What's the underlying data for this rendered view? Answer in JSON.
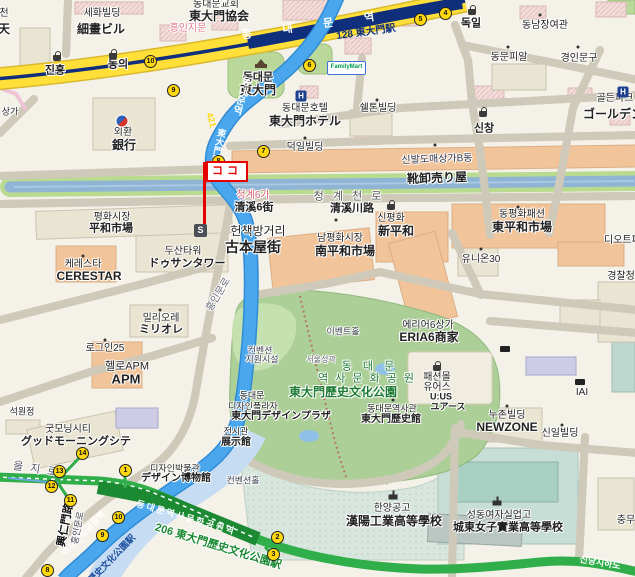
{
  "map": {
    "markers": {
      "koko": "ココ",
      "s": "S",
      "familymart": "FamilyMart"
    },
    "palette": {
      "bg": "#f4f1e8",
      "road_yellow": "#ffdf38",
      "line1_navy": "#0f2f7d",
      "line4_blue": "#4aa7ee",
      "line4_casing": "#2f8cd4",
      "line4_band": "#c6dcf2",
      "line2_green": "#2fae4a",
      "line2_dark": "#1c8a33",
      "stream_water": "#8fb4d4",
      "stream_bank": "#b9db90",
      "park_green": "#accf97",
      "park_light": "#c8e2b2",
      "bldg_salmon": "#f2c49a",
      "bldg_tan": "#eae4d2",
      "bldg_pink": "#f3dbd9",
      "bldg_lavender": "#cdcbe6",
      "school_teal": "#c7ded6",
      "exit_yellow": "#ffd80e",
      "flag_red": "#e60000",
      "park_label_green": "#1c7a33"
    },
    "labels": [
      {
        "i": "chun-ko",
        "t": "천",
        "x": 4,
        "y": 14,
        "s": 10
      },
      {
        "i": "chun-ja",
        "t": "天",
        "x": 4,
        "y": 29,
        "s": 12,
        "b": 1
      },
      {
        "i": "sehwa-ko",
        "t": "세화빌딩",
        "x": 102,
        "y": 14,
        "s": 10
      },
      {
        "i": "sehwa-ja",
        "t": "細畫ビル",
        "x": 101,
        "y": 29,
        "s": 12,
        "b": 1
      },
      {
        "i": "church-ko",
        "t": "동대문교회",
        "x": 216,
        "y": 5,
        "s": 10
      },
      {
        "i": "church-ja",
        "t": "東大門協会",
        "x": 219,
        "y": 16,
        "s": 12,
        "b": 1
      },
      {
        "i": "heunginjimun",
        "t": "흥인지문",
        "x": 188,
        "y": 29,
        "s": 10,
        "c": "#e2798f"
      },
      {
        "i": "jinheung",
        "t": "진흥",
        "x": 55,
        "y": 71,
        "s": 11,
        "b": 1
      },
      {
        "i": "dongui",
        "t": "동의",
        "x": 118,
        "y": 65,
        "s": 11,
        "b": 1
      },
      {
        "i": "line1-name",
        "t": "동 대 문 역",
        "x": 315,
        "y": 26,
        "s": 11,
        "b": 1,
        "c": "#fff",
        "r": -8,
        "ls": 14,
        "h": 0
      },
      {
        "i": "line1-code",
        "t": "128  東大門駅",
        "x": 366,
        "y": 33,
        "s": 10,
        "b": 1,
        "c": "#10307e",
        "r": -8,
        "h": 0
      },
      {
        "i": "dokil",
        "t": "독일",
        "x": 471,
        "y": 24,
        "s": 11,
        "b": 1
      },
      {
        "i": "dongnam",
        "t": "동남장여관",
        "x": 545,
        "y": 26,
        "s": 10
      },
      {
        "i": "dongmun",
        "t": "동문피알",
        "x": 509,
        "y": 58,
        "s": 10
      },
      {
        "i": "gyeongin",
        "t": "경인문구",
        "x": 579,
        "y": 59,
        "s": 10
      },
      {
        "i": "golden-ko",
        "t": "골든파크",
        "x": 615,
        "y": 99,
        "s": 10
      },
      {
        "i": "golden-ja",
        "t": "ゴールデン",
        "x": 613,
        "y": 114,
        "s": 12,
        "b": 1
      },
      {
        "i": "ddm-ko",
        "t": "동대문",
        "x": 258,
        "y": 78,
        "s": 11,
        "b": 1
      },
      {
        "i": "ddm-ja",
        "t": "東大門",
        "x": 258,
        "y": 90,
        "s": 12,
        "b": 1
      },
      {
        "i": "hotel-ko",
        "t": "동대문호텔",
        "x": 305,
        "y": 109,
        "s": 10
      },
      {
        "i": "hotel-ja",
        "t": "東大門ホテル",
        "x": 305,
        "y": 121,
        "s": 12,
        "b": 1
      },
      {
        "i": "sheldon",
        "t": "쉘톤빌딩",
        "x": 378,
        "y": 109,
        "s": 10
      },
      {
        "i": "sinchang",
        "t": "신창",
        "x": 484,
        "y": 129,
        "s": 11,
        "b": 1
      },
      {
        "i": "keb-ko",
        "t": "외환",
        "x": 123,
        "y": 133,
        "s": 10
      },
      {
        "i": "keb-ja",
        "t": "銀行",
        "x": 124,
        "y": 145,
        "s": 12,
        "b": 1
      },
      {
        "i": "deokil",
        "t": "덕일빌딩",
        "x": 305,
        "y": 148,
        "s": 10
      },
      {
        "i": "l4-name",
        "t": "동대문역",
        "x": 240,
        "y": 95,
        "s": 10,
        "b": 1,
        "c": "#fff",
        "v": 1,
        "r": 16,
        "h": 0
      },
      {
        "i": "l4-code",
        "t": "421",
        "x": 211,
        "y": 120,
        "s": 9,
        "b": 1,
        "c": "#ffd80e",
        "r": 74,
        "h": 0
      },
      {
        "i": "l4-ja",
        "t": "東大門駅",
        "x": 218,
        "y": 146,
        "s": 9,
        "b": 1,
        "c": "#fff",
        "v": 1,
        "r": 12,
        "h": 0
      },
      {
        "i": "shoe-ko",
        "t": "신발도매상가B동",
        "x": 437,
        "y": 160,
        "s": 10,
        "c": "#334",
        "r": -2
      },
      {
        "i": "shoe-ja",
        "t": "靴卸売り屋",
        "x": 437,
        "y": 178,
        "s": 12,
        "b": 1,
        "r": -2
      },
      {
        "i": "cg6-ko",
        "t": "청계6가",
        "x": 253,
        "y": 196,
        "s": 10,
        "c": "#d8607a"
      },
      {
        "i": "cg6-ja",
        "t": "清溪6街",
        "x": 254,
        "y": 208,
        "s": 11,
        "b": 1
      },
      {
        "i": "cgro-ko",
        "t": "청 계 천 로",
        "x": 349,
        "y": 197,
        "s": 11,
        "c": "#555",
        "ls": 3
      },
      {
        "i": "cgro-ja",
        "t": "清溪川路",
        "x": 352,
        "y": 209,
        "s": 11,
        "b": 1
      },
      {
        "i": "sp-ko",
        "t": "신평화",
        "x": 391,
        "y": 219,
        "s": 10
      },
      {
        "i": "sp-ja",
        "t": "新平和",
        "x": 396,
        "y": 231,
        "s": 12,
        "b": 1
      },
      {
        "i": "np-ko",
        "t": "남평화시장",
        "x": 340,
        "y": 239,
        "s": 10
      },
      {
        "i": "np-ja",
        "t": "南平和市場",
        "x": 345,
        "y": 251,
        "s": 12,
        "b": 1
      },
      {
        "i": "dp-ko",
        "t": "동평화패션",
        "x": 522,
        "y": 215,
        "s": 10
      },
      {
        "i": "dp-ja",
        "t": "東平和市場",
        "x": 522,
        "y": 227,
        "s": 12,
        "b": 1
      },
      {
        "i": "diot",
        "t": "디오트패션",
        "x": 627,
        "y": 241,
        "s": 10
      },
      {
        "i": "ph-ko",
        "t": "평화시장",
        "x": 112,
        "y": 218,
        "s": 10
      },
      {
        "i": "ph-ja",
        "t": "平和市場",
        "x": 111,
        "y": 229,
        "s": 11,
        "b": 1
      },
      {
        "i": "book-ko",
        "t": "헌책방거리",
        "x": 258,
        "y": 231,
        "s": 12
      },
      {
        "i": "book-ja",
        "t": "古本屋街",
        "x": 253,
        "y": 247,
        "s": 14,
        "b": 1
      },
      {
        "i": "ceres-ko",
        "t": "케레스타",
        "x": 83,
        "y": 265,
        "s": 10
      },
      {
        "i": "ceres-en",
        "t": "CERESTAR",
        "x": 89,
        "y": 276,
        "s": 12,
        "b": 1
      },
      {
        "i": "doosan-ko",
        "t": "두산타워",
        "x": 183,
        "y": 252,
        "s": 10
      },
      {
        "i": "doosan-ja",
        "t": "ドゥサンタワー",
        "x": 187,
        "y": 264,
        "s": 11,
        "b": 1
      },
      {
        "i": "union30",
        "t": "유니온30",
        "x": 481,
        "y": 260,
        "s": 10
      },
      {
        "i": "police",
        "t": "경찰청",
        "x": 621,
        "y": 277,
        "s": 10
      },
      {
        "i": "hi-top",
        "t": "흥인문로",
        "x": 219,
        "y": 295,
        "s": 10,
        "c": "#667",
        "r": -59
      },
      {
        "i": "eria-ko",
        "t": "에리어6상가",
        "x": 428,
        "y": 326,
        "s": 10
      },
      {
        "i": "eria-ja",
        "t": "ERIA6商家",
        "x": 429,
        "y": 337,
        "s": 12,
        "b": 1
      },
      {
        "i": "mig-ko",
        "t": "밀리오레",
        "x": 161,
        "y": 319,
        "s": 10
      },
      {
        "i": "mig-ja",
        "t": "ミリオレ",
        "x": 161,
        "y": 330,
        "s": 11,
        "b": 1
      },
      {
        "i": "login25",
        "t": "로그인25",
        "x": 105,
        "y": 349,
        "s": 10
      },
      {
        "i": "apm-ko",
        "t": "헬로APM",
        "x": 127,
        "y": 367,
        "s": 11
      },
      {
        "i": "apm-en",
        "t": "APM",
        "x": 126,
        "y": 379,
        "s": 13,
        "b": 1
      },
      {
        "i": "event",
        "t": "이벤트홀",
        "x": 343,
        "y": 332,
        "s": 9,
        "c": "#445"
      },
      {
        "i": "fortress",
        "t": "서울성곽",
        "x": 321,
        "y": 360,
        "s": 8,
        "c": "#667"
      },
      {
        "i": "conv1",
        "t": "컨벤션",
        "x": 260,
        "y": 351,
        "s": 9,
        "c": "#445"
      },
      {
        "i": "conv2",
        "t": "지원시설",
        "x": 262,
        "y": 360,
        "s": 9,
        "c": "#445"
      },
      {
        "i": "park-ko1",
        "t": "동 대 문",
        "x": 370,
        "y": 367,
        "s": 11,
        "c": "#1c7a33",
        "ls": 4
      },
      {
        "i": "park-ko2",
        "t": "역 사 문 화 공 원",
        "x": 367,
        "y": 379,
        "s": 11,
        "c": "#1c7a33",
        "ls": 2
      },
      {
        "i": "park-ja",
        "t": "東大門歷史文化公園",
        "x": 343,
        "y": 392,
        "s": 12,
        "b": 1,
        "c": "#1c7a33"
      },
      {
        "i": "ddp1",
        "t": "동대문",
        "x": 252,
        "y": 396,
        "s": 9
      },
      {
        "i": "ddp2",
        "t": "디자인플라자",
        "x": 253,
        "y": 407,
        "s": 9
      },
      {
        "i": "ddp3",
        "t": "東大門デザインプラザ",
        "x": 281,
        "y": 417,
        "s": 10,
        "b": 1
      },
      {
        "i": "hist-ko",
        "t": "동대문역사관",
        "x": 392,
        "y": 409,
        "s": 9
      },
      {
        "i": "hist-ja",
        "t": "東大門歷史館",
        "x": 391,
        "y": 420,
        "s": 10,
        "b": 1
      },
      {
        "i": "exh-ko",
        "t": "전시관",
        "x": 236,
        "y": 432,
        "s": 9
      },
      {
        "i": "exh-ja",
        "t": "展示館",
        "x": 236,
        "y": 443,
        "s": 10,
        "b": 1
      },
      {
        "i": "fm1",
        "t": "패션몰",
        "x": 437,
        "y": 378,
        "s": 10
      },
      {
        "i": "fm2",
        "t": "유어스",
        "x": 437,
        "y": 388,
        "s": 10
      },
      {
        "i": "fm3",
        "t": "U:US",
        "x": 441,
        "y": 397,
        "s": 9,
        "b": 1
      },
      {
        "i": "fm4",
        "t": "ユアース",
        "x": 448,
        "y": 407,
        "s": 9,
        "b": 1
      },
      {
        "i": "nz-ko",
        "t": "누존빌딩",
        "x": 507,
        "y": 416,
        "s": 10
      },
      {
        "i": "nz-en",
        "t": "NEWZONE",
        "x": 507,
        "y": 427,
        "s": 12,
        "b": 1
      },
      {
        "i": "sinil",
        "t": "신일빌딩",
        "x": 560,
        "y": 434,
        "s": 10
      },
      {
        "i": "gmc-ko",
        "t": "굿모닝시티",
        "x": 68,
        "y": 430,
        "s": 10
      },
      {
        "i": "gmc-ja",
        "t": "グッドモーニングシテ",
        "x": 76,
        "y": 442,
        "s": 11,
        "b": 1
      },
      {
        "i": "seok",
        "t": "석원정",
        "x": 22,
        "y": 412,
        "s": 9
      },
      {
        "i": "euljiro",
        "t": "을 지 로",
        "x": 36,
        "y": 470,
        "s": 11,
        "c": "#556",
        "r": 9,
        "ls": 2
      },
      {
        "i": "dm-ko",
        "t": "디자인박물관",
        "x": 175,
        "y": 469,
        "s": 9
      },
      {
        "i": "dm-ja",
        "t": "デザイン博物館",
        "x": 176,
        "y": 479,
        "s": 10,
        "b": 1
      },
      {
        "i": "convhall",
        "t": "컨벤션홀",
        "x": 243,
        "y": 481,
        "s": 9,
        "c": "#445"
      },
      {
        "i": "l2-name",
        "t": "동대문역사문화공원역",
        "x": 186,
        "y": 518,
        "s": 9,
        "b": 1,
        "c": "#fff",
        "r": 16,
        "ls": 2,
        "h": 0
      },
      {
        "i": "l2-code",
        "t": "206  東大門歷史文化公園駅",
        "x": 218,
        "y": 547,
        "s": 11,
        "b": 1,
        "c": "#1c8a33",
        "r": 17
      },
      {
        "i": "l4b-ko",
        "t": "역사문화공원역",
        "x": 84,
        "y": 534,
        "s": 9,
        "b": 1,
        "c": "#fff",
        "r": -46,
        "h": 0
      },
      {
        "i": "l4b-ja",
        "t": "歷史文化公園駅",
        "x": 112,
        "y": 559,
        "s": 9,
        "b": 1,
        "c": "#1b4f9e",
        "r": -46,
        "h": 0
      },
      {
        "i": "hi-ko",
        "t": "흥인문로",
        "x": 78,
        "y": 528,
        "s": 9,
        "c": "#445",
        "r": -79
      },
      {
        "i": "hi-ja",
        "t": "興仁門路",
        "x": 66,
        "y": 525,
        "s": 11,
        "b": 1,
        "c": "#111",
        "r": -79
      },
      {
        "i": "hanyang-ko",
        "t": "한양공고",
        "x": 392,
        "y": 509,
        "s": 10
      },
      {
        "i": "hanyang-ja",
        "t": "漢陽工業高等學校",
        "x": 394,
        "y": 521,
        "s": 12,
        "b": 1
      },
      {
        "i": "sd-ko",
        "t": "성동여자실업고",
        "x": 499,
        "y": 516,
        "s": 10
      },
      {
        "i": "sd-ja",
        "t": "城東女子實業高等學校",
        "x": 508,
        "y": 528,
        "s": 11,
        "b": 1
      },
      {
        "i": "chungmu",
        "t": "충무",
        "x": 626,
        "y": 521,
        "s": 10
      },
      {
        "i": "sindang",
        "t": "신당지하도",
        "x": 600,
        "y": 563,
        "s": 9,
        "b": 1,
        "c": "#fff",
        "r": 10,
        "h": 0
      },
      {
        "i": "iai",
        "t": "IAI",
        "x": 582,
        "y": 393,
        "s": 10
      },
      {
        "i": "sangga",
        "t": "상가",
        "x": 10,
        "y": 112,
        "s": 9
      }
    ],
    "subway_exits": [
      {
        "n": "10",
        "x": 150,
        "y": 61
      },
      {
        "n": "9",
        "x": 173,
        "y": 90
      },
      {
        "n": "6",
        "x": 309,
        "y": 65
      },
      {
        "n": "5",
        "x": 420,
        "y": 19
      },
      {
        "n": "4",
        "x": 445,
        "y": 13
      },
      {
        "n": "7",
        "x": 263,
        "y": 151
      },
      {
        "n": "8",
        "x": 218,
        "y": 161
      },
      {
        "n": "14",
        "x": 82,
        "y": 453
      },
      {
        "n": "13",
        "x": 59,
        "y": 471
      },
      {
        "n": "12",
        "x": 51,
        "y": 486
      },
      {
        "n": "11",
        "x": 70,
        "y": 500
      },
      {
        "n": "1",
        "x": 125,
        "y": 470
      },
      {
        "n": "10",
        "x": 118,
        "y": 517
      },
      {
        "n": "9",
        "x": 102,
        "y": 535
      },
      {
        "n": "8",
        "x": 47,
        "y": 570
      },
      {
        "n": "2",
        "x": 277,
        "y": 537
      },
      {
        "n": "3",
        "x": 273,
        "y": 554
      }
    ],
    "icons": [
      {
        "k": "bag",
        "x": 57,
        "y": 58
      },
      {
        "k": "bag",
        "x": 113,
        "y": 56
      },
      {
        "k": "bag",
        "x": 472,
        "y": 12
      },
      {
        "k": "bag",
        "x": 483,
        "y": 114
      },
      {
        "k": "bag",
        "x": 391,
        "y": 207
      },
      {
        "k": "bag",
        "x": 437,
        "y": 368
      },
      {
        "k": "hotel",
        "x": 301,
        "y": 96,
        "t": "H"
      },
      {
        "k": "hotel",
        "x": 623,
        "y": 92,
        "t": "H"
      },
      {
        "k": "temple",
        "x": 261,
        "y": 66
      },
      {
        "k": "school",
        "x": 393,
        "y": 497
      },
      {
        "k": "school",
        "x": 497,
        "y": 503
      },
      {
        "k": "keb",
        "x": 122,
        "y": 121
      },
      {
        "k": "tinybox",
        "x": 505,
        "y": 349
      },
      {
        "k": "tinybox",
        "x": 580,
        "y": 382
      },
      {
        "k": "dot",
        "x": 377,
        "y": 100
      },
      {
        "k": "dot",
        "x": 305,
        "y": 138
      },
      {
        "k": "dot",
        "x": 160,
        "y": 310
      },
      {
        "k": "dot",
        "x": 105,
        "y": 340
      },
      {
        "k": "dot",
        "x": 336,
        "y": 220
      },
      {
        "k": "dot",
        "x": 518,
        "y": 207
      },
      {
        "k": "dot",
        "x": 507,
        "y": 406
      },
      {
        "k": "dot",
        "x": 562,
        "y": 425
      },
      {
        "k": "dot",
        "x": 481,
        "y": 249
      },
      {
        "k": "dot",
        "x": 83,
        "y": 256
      },
      {
        "k": "dot",
        "x": 540,
        "y": 15
      },
      {
        "k": "dot",
        "x": 578,
        "y": 47
      },
      {
        "k": "dot",
        "x": 508,
        "y": 47
      },
      {
        "k": "dot",
        "x": 435,
        "y": 145
      },
      {
        "k": "dot",
        "x": 393,
        "y": 400
      }
    ]
  }
}
